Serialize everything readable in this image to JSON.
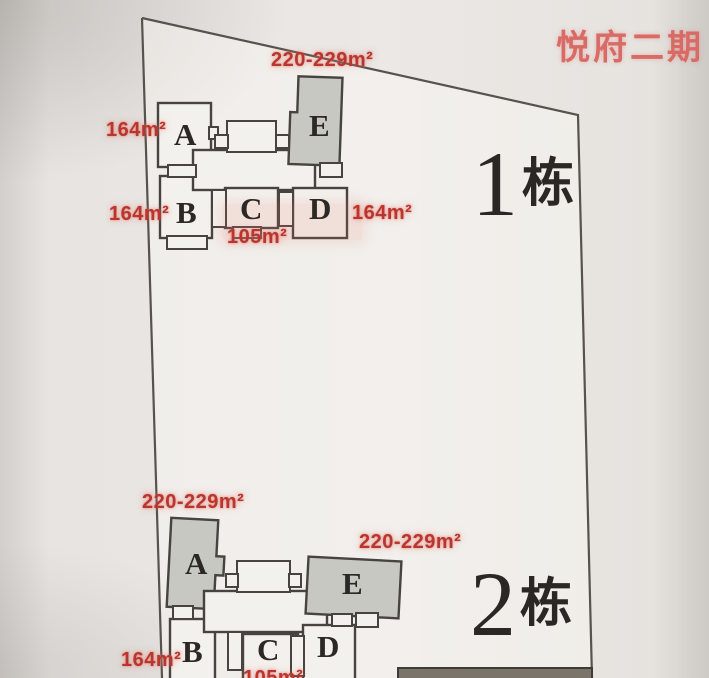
{
  "header": {
    "title": "悦府二期"
  },
  "b1": {
    "name": "1栋",
    "number": "1",
    "suffix": "栋",
    "units": {
      "a": "A",
      "b": "B",
      "c": "C",
      "d": "D",
      "e": "E"
    },
    "areas": {
      "a": "164m²",
      "b": "164m²",
      "c": "105m²",
      "d": "164m²",
      "e": "220-229m²"
    }
  },
  "b2": {
    "name": "2栋",
    "number": "2",
    "suffix": "栋",
    "units": {
      "a": "A",
      "b": "B",
      "c": "C",
      "d": "D",
      "e": "E"
    },
    "areas": {
      "a": "220-229m²",
      "b": "164m²",
      "c": "105m²",
      "e": "220-229m²"
    }
  },
  "colors": {
    "accent_red": "#b9362e",
    "title_red": "#d96b66",
    "unit_gray": "#c7c8c2",
    "unit_white": "#f3f1ed",
    "line_dark": "#47433f"
  }
}
